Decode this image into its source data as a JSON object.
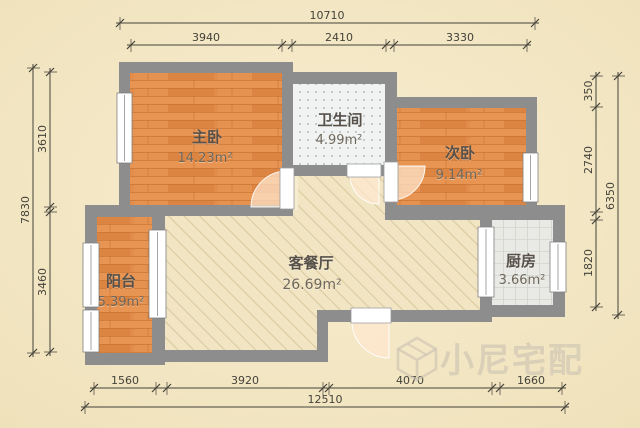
{
  "palette": {
    "bgLight": "#f7edd0",
    "bgDark": "#efe1ba",
    "wall": "#8d8d8d",
    "wallEdge": "#7a7a7a",
    "wood": "#e18c4b",
    "woodLine": "#c4702d",
    "woodLight": "#ef9f60",
    "woodDark": "#d87e3a",
    "bathBase": "#f0f3f2",
    "bathDot": "#a3abaf",
    "kitchenBase": "#e9eae5",
    "kitchenLine": "#d2d4cd",
    "hatchBase": "#f1e5c4",
    "hatchLine": "#dbc99c",
    "dim": "#44423a",
    "label": "#57514a",
    "labelArea": "#6e675b",
    "windowFill": "#ffffff",
    "windowEdge": "#7f7f7f",
    "doorFill": "rgba(255,231,206,0.72)",
    "doorEdge": "rgba(255,255,255,0.9)",
    "watermark": "rgba(203,194,177,0.62)"
  },
  "rooms": {
    "master": {
      "name": "主卧",
      "area": "14.23m²"
    },
    "bathroom": {
      "name": "卫生间",
      "area": "4.99m²"
    },
    "second": {
      "name": "次卧",
      "area": "9.14m²"
    },
    "living": {
      "name": "客餐厅",
      "area": "26.69m²"
    },
    "balcony": {
      "name": "阳台",
      "area": "5.39m²"
    },
    "kitchen": {
      "name": "厨房",
      "area": "3.66m²"
    }
  },
  "dimensions": {
    "top": {
      "overall": "10710",
      "segments": [
        "3940",
        "2410",
        "3330"
      ]
    },
    "bottom": {
      "overall": "12510",
      "segments": [
        "1560",
        "3920",
        "4070",
        "1660"
      ]
    },
    "left": {
      "overall": "7830",
      "segments": [
        "3610",
        "3460"
      ]
    },
    "right": {
      "overall": "6350",
      "segments": [
        "350",
        "2740",
        "1820"
      ]
    }
  },
  "watermark": {
    "text": "小尼宅配"
  }
}
